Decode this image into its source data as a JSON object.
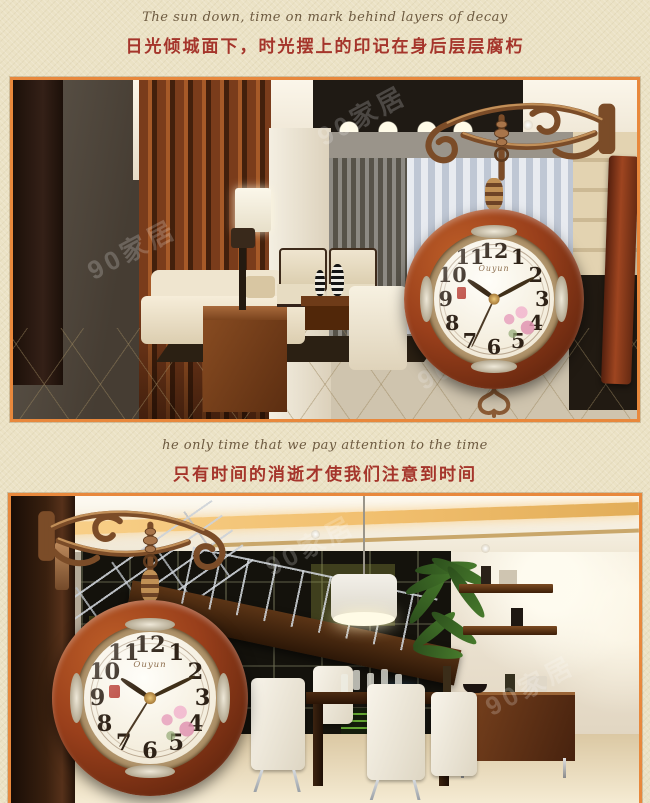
{
  "page": {
    "background": "#ebe2c5",
    "frame_color": "#e8883c",
    "caption_color": "#a5352b"
  },
  "sections": [
    {
      "caption_en": "The sun down, time on mark behind layers of decay",
      "caption_zh": "日光倾城面下，时光摆上的印记在身后层层腐朽"
    },
    {
      "caption_en": "he only time that we pay attention to the time",
      "caption_zh": "只有时间的消逝才使我们注意到时间"
    }
  ],
  "watermark": "90家居",
  "clock": {
    "brand": "Ouyun",
    "numerals": [
      "12",
      "1",
      "2",
      "3",
      "4",
      "5",
      "6",
      "7",
      "8",
      "9",
      "10",
      "11"
    ],
    "scene1_time": {
      "hour": 305,
      "minute": 62,
      "second": 205
    },
    "scene2_time": {
      "hour": 304,
      "minute": 64,
      "second": 212
    }
  }
}
